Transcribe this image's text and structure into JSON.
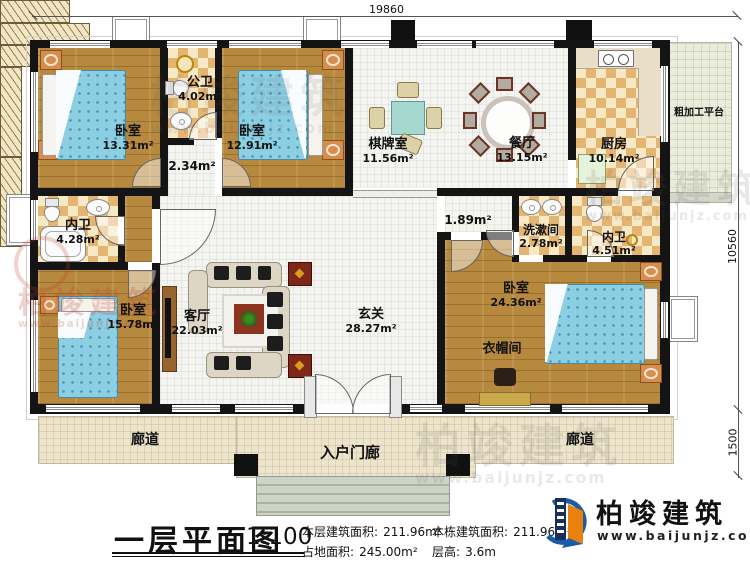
{
  "title": {
    "text": "一层平面图",
    "scale": "1:100"
  },
  "dimensions": {
    "top": "19860",
    "right": "10560",
    "porch": "1500"
  },
  "stats": {
    "floor_area_label": "本层建筑面积:",
    "floor_area": "211.96m²",
    "land_label": "占地面积:",
    "land": "245.00m²",
    "building_label": "本栋建筑面积:",
    "building": "211.96m²",
    "height_label": "层高:",
    "height": "3.6m"
  },
  "brand": {
    "name": "柏竣建筑",
    "url": "www.baijunjz.com"
  },
  "rooms": {
    "bedroom_tl": {
      "name": "卧室",
      "area": "13.31m²"
    },
    "public_bath": {
      "name": "公卫",
      "area": "4.02m²"
    },
    "hall_small": {
      "area": "2.34m²"
    },
    "bedroom_tm": {
      "name": "卧室",
      "area": "12.91m²"
    },
    "chess_room": {
      "name": "棋牌室",
      "area": "11.56m²"
    },
    "dining": {
      "name": "餐厅",
      "area": "13.15m²"
    },
    "kitchen": {
      "name": "厨房",
      "area": "10.14m²"
    },
    "platform": {
      "name": "粗加工平台"
    },
    "inner_bath_left": {
      "name": "内卫",
      "area": "4.28m²"
    },
    "bedroom_bl": {
      "name": "卧室",
      "area": "15.78m²"
    },
    "living": {
      "name": "客厅",
      "area": "22.03m²"
    },
    "foyer": {
      "name": "玄关",
      "area": "28.27m²"
    },
    "corridor_small": {
      "area": "1.89m²"
    },
    "washroom": {
      "name": "洗漱间",
      "area": "2.78m²"
    },
    "inner_bath_right": {
      "name": "内卫",
      "area": "4.51m²"
    },
    "bedroom_master": {
      "name": "卧室",
      "area": "24.36m²"
    },
    "cloakroom": {
      "name": "衣帽间"
    },
    "corridor_left": {
      "name": "廊道"
    },
    "corridor_right": {
      "name": "廊道"
    },
    "porch": {
      "name": "入户门廊"
    }
  }
}
